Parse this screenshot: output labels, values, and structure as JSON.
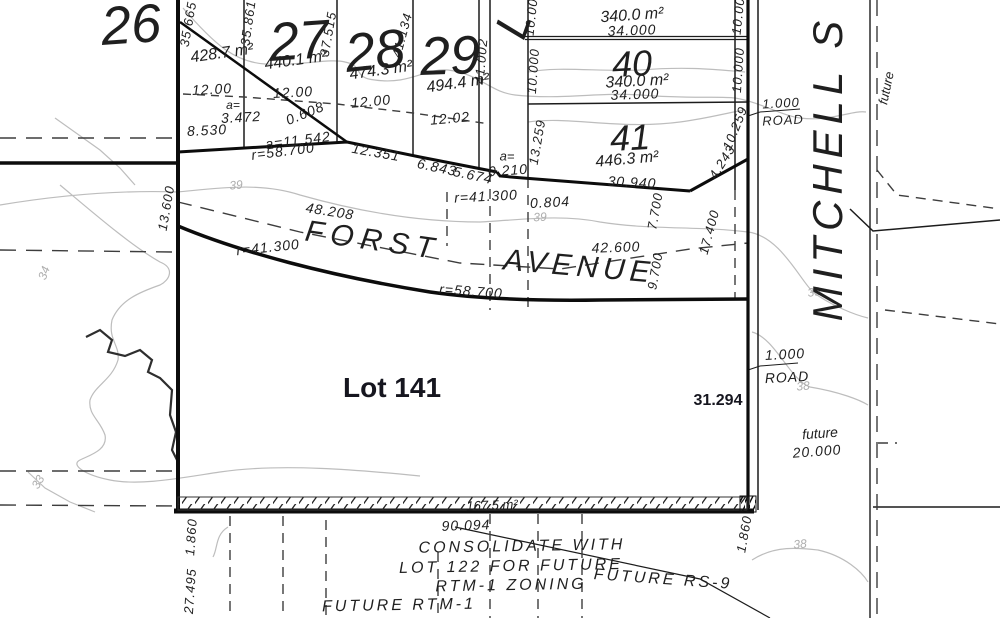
{
  "map": {
    "type": "cadastral-survey-plat",
    "colors": {
      "background": "#ffffff",
      "heavy_line": "#0c0c0c",
      "thin_line": "#1c1c1c",
      "dashed_line": "#3d3d3d",
      "contour_line": "#bdbdbd",
      "survey_text": "#1f1f1f",
      "annotation_text": "#16161f",
      "contour_text": "#aeaeae"
    },
    "streets": [
      "FORST AVENUE",
      "MITCHELL S"
    ],
    "labels": [
      {
        "id": "lot26-number",
        "t": "26",
        "x": 131,
        "y": 25,
        "r": -4,
        "s": 54
      },
      {
        "id": "lot26-area",
        "t": "428.7 m²",
        "x": 222,
        "y": 54,
        "r": -8,
        "s": 16
      },
      {
        "id": "lot27-number",
        "t": "27",
        "x": 299,
        "y": 41,
        "r": -4,
        "s": 54
      },
      {
        "id": "lot27-area",
        "t": "440.1 m²",
        "x": 296,
        "y": 61,
        "r": -8,
        "s": 16
      },
      {
        "id": "lot28-number",
        "t": "28",
        "x": 375,
        "y": 51,
        "r": -6,
        "s": 54
      },
      {
        "id": "lot28-area",
        "t": "474.3 m²",
        "x": 381,
        "y": 71,
        "r": -8,
        "s": 16
      },
      {
        "id": "lot29-number",
        "t": "29",
        "x": 450,
        "y": 56,
        "r": -2,
        "s": 54
      },
      {
        "id": "lot29-area",
        "t": "494.4 m²",
        "x": 458,
        "y": 84,
        "r": -8,
        "s": 16
      },
      {
        "id": "dim-35-665",
        "t": "35.665",
        "x": 188,
        "y": 24,
        "r": -80,
        "s": 13,
        "sp": 1
      },
      {
        "id": "dim-35-861",
        "t": "35.861",
        "x": 248,
        "y": 23,
        "r": -82,
        "s": 13,
        "sp": 1
      },
      {
        "id": "dim-37-515",
        "t": "37.515",
        "x": 328,
        "y": 34,
        "r": -80,
        "s": 13,
        "sp": 1
      },
      {
        "id": "dim-41-134",
        "t": "41.134",
        "x": 402,
        "y": 35,
        "r": -75,
        "s": 13,
        "sp": 1
      },
      {
        "id": "dim-41-002",
        "t": "41.002",
        "x": 481,
        "y": 61,
        "r": -85,
        "s": 13,
        "sp": 1
      },
      {
        "id": "zoning-fragment",
        "t": "RS 9",
        "x": 345,
        "y": -17,
        "r": 0,
        "s": 46,
        "sp": 14
      },
      {
        "id": "street-l-fragment",
        "t": "L",
        "x": 513,
        "y": 24,
        "r": -70,
        "s": 46
      },
      {
        "id": "lot39-area",
        "t": "340.0 m²",
        "x": 632,
        "y": 16,
        "r": -4,
        "s": 16
      },
      {
        "id": "lot39-frontage",
        "t": "34.000",
        "x": 632,
        "y": 30,
        "r": -2,
        "s": 14,
        "sp": 1
      },
      {
        "id": "lot40-number",
        "t": "40",
        "x": 632,
        "y": 64,
        "r": -3,
        "s": 36
      },
      {
        "id": "lot40-area",
        "t": "340.0 m²",
        "x": 637,
        "y": 82,
        "r": -3,
        "s": 16
      },
      {
        "id": "lot40-frontage",
        "t": "34.000",
        "x": 635,
        "y": 94,
        "r": -2,
        "s": 14,
        "sp": 1
      },
      {
        "id": "lot41-number",
        "t": "41",
        "x": 630,
        "y": 138,
        "r": -3,
        "s": 36
      },
      {
        "id": "lot41-area",
        "t": "446.3 m²",
        "x": 627,
        "y": 160,
        "r": -5,
        "s": 16
      },
      {
        "id": "dim-10-00-left39",
        "t": "10.00",
        "x": 531,
        "y": 17,
        "r": -84,
        "s": 13,
        "sp": 1
      },
      {
        "id": "dim-10-000-left40",
        "t": "10.000",
        "x": 533,
        "y": 71,
        "r": -86,
        "s": 13,
        "sp": 1
      },
      {
        "id": "dim-10-00-right39",
        "t": "10.00",
        "x": 738,
        "y": 16,
        "r": -84,
        "s": 13,
        "sp": 1
      },
      {
        "id": "dim-10-000-right40",
        "t": "10.000",
        "x": 738,
        "y": 70,
        "r": -86,
        "s": 13,
        "sp": 1
      },
      {
        "id": "dim-13-259",
        "t": "13.259",
        "x": 537,
        "y": 142,
        "r": -80,
        "s": 13,
        "sp": 1
      },
      {
        "id": "dim-10-259",
        "t": "10.259",
        "x": 735,
        "y": 128,
        "r": -68,
        "s": 13,
        "sp": 1
      },
      {
        "id": "dim-4-243",
        "t": "4.243",
        "x": 722,
        "y": 162,
        "r": -58,
        "s": 13,
        "sp": 1
      },
      {
        "id": "dim-30-940",
        "t": "30.940",
        "x": 632,
        "y": 182,
        "r": 3,
        "s": 14,
        "sp": 1
      },
      {
        "id": "dim-a-equals-e",
        "t": "a=",
        "x": 507,
        "y": 156,
        "r": 0,
        "s": 13
      },
      {
        "id": "dim-0-210",
        "t": "0.210",
        "x": 508,
        "y": 170,
        "r": -4,
        "s": 14,
        "sp": 1
      },
      {
        "id": "dim-12-00-a",
        "t": "12.00",
        "x": 212,
        "y": 89,
        "r": -3,
        "s": 14,
        "sp": 1
      },
      {
        "id": "dim-12-00-b",
        "t": "12.00",
        "x": 293,
        "y": 92,
        "r": -3,
        "s": 14,
        "sp": 1
      },
      {
        "id": "dim-12-00-c",
        "t": "12.00",
        "x": 371,
        "y": 101,
        "r": -5,
        "s": 14,
        "sp": 1
      },
      {
        "id": "dim-12-02",
        "t": "12.02",
        "x": 450,
        "y": 118,
        "r": -5,
        "s": 14,
        "sp": 1
      },
      {
        "id": "dim-a-equals-w",
        "t": "a=",
        "x": 233,
        "y": 105,
        "r": 0,
        "s": 12
      },
      {
        "id": "dim-3-472",
        "t": "3.472",
        "x": 241,
        "y": 117,
        "r": -3,
        "s": 14,
        "sp": 1
      },
      {
        "id": "dim-8-530",
        "t": "8.530",
        "x": 207,
        "y": 130,
        "r": -3,
        "s": 14,
        "sp": 1
      },
      {
        "id": "dim-0-608",
        "t": "0.608",
        "x": 305,
        "y": 113,
        "r": -22,
        "s": 14,
        "sp": 1
      },
      {
        "id": "dim-a-11-542",
        "t": "a=11.542",
        "x": 298,
        "y": 140,
        "r": -7,
        "s": 14,
        "sp": 1
      },
      {
        "id": "dim-r-58-700-n",
        "t": "r=58.700",
        "x": 283,
        "y": 151,
        "r": -7,
        "s": 14,
        "sp": 1
      },
      {
        "id": "dim-12-351",
        "t": "12.351",
        "x": 376,
        "y": 152,
        "r": 10,
        "s": 14,
        "sp": 1
      },
      {
        "id": "dim-6-843",
        "t": "6.843",
        "x": 437,
        "y": 167,
        "r": 12,
        "s": 14,
        "sp": 1
      },
      {
        "id": "dim-5-674",
        "t": "5.674",
        "x": 473,
        "y": 175,
        "r": 12,
        "s": 14,
        "sp": 1
      },
      {
        "id": "dim-13-600",
        "t": "13.600",
        "x": 166,
        "y": 208,
        "r": -80,
        "s": 13,
        "sp": 1
      },
      {
        "id": "dim-48-208",
        "t": "48.208",
        "x": 330,
        "y": 211,
        "r": 9,
        "s": 14,
        "sp": 1
      },
      {
        "id": "street-forst",
        "t": "FORST",
        "x": 373,
        "y": 241,
        "r": 8,
        "s": 30,
        "sp": 7
      },
      {
        "id": "street-avenue",
        "t": "AVENUE",
        "x": 579,
        "y": 267,
        "r": 5,
        "s": 30,
        "sp": 5
      },
      {
        "id": "dim-r-41-300-w",
        "t": "r=41.300",
        "x": 268,
        "y": 247,
        "r": -6,
        "s": 14,
        "sp": 1
      },
      {
        "id": "dim-r-41-300-e",
        "t": "r=41.300",
        "x": 486,
        "y": 196,
        "r": -3,
        "s": 14,
        "sp": 1
      },
      {
        "id": "dim-0-804",
        "t": "0.804",
        "x": 550,
        "y": 202,
        "r": -3,
        "s": 14,
        "sp": 1
      },
      {
        "id": "dim-42-600",
        "t": "42.600",
        "x": 616,
        "y": 247,
        "r": -2,
        "s": 14,
        "sp": 1
      },
      {
        "id": "dim-r-58-700-s",
        "t": "r=58.700",
        "x": 471,
        "y": 291,
        "r": 4,
        "s": 14,
        "sp": 1
      },
      {
        "id": "dim-7-700",
        "t": "7.700",
        "x": 655,
        "y": 211,
        "r": -80,
        "s": 13,
        "sp": 1
      },
      {
        "id": "dim-9-700",
        "t": "9.700",
        "x": 655,
        "y": 271,
        "r": -80,
        "s": 13,
        "sp": 1
      },
      {
        "id": "dim-17-400",
        "t": "17.400",
        "x": 709,
        "y": 232,
        "r": -75,
        "s": 13,
        "sp": 1
      },
      {
        "id": "contour-39-a",
        "t": "39",
        "x": 236,
        "y": 185,
        "r": -5,
        "s": 12,
        "f": "contour-lbl"
      },
      {
        "id": "contour-39-b",
        "t": "39",
        "x": 540,
        "y": 217,
        "r": -3,
        "s": 12,
        "f": "contour-lbl"
      },
      {
        "id": "contour-39-c",
        "t": "39",
        "x": 814,
        "y": 292,
        "r": -8,
        "s": 12,
        "f": "contour-lbl"
      },
      {
        "id": "contour-38-a",
        "t": "38",
        "x": 803,
        "y": 386,
        "r": -5,
        "s": 12,
        "f": "contour-lbl"
      },
      {
        "id": "contour-38-b",
        "t": "38",
        "x": 800,
        "y": 544,
        "r": -5,
        "s": 12,
        "f": "contour-lbl"
      },
      {
        "id": "contour-34",
        "t": "34",
        "x": 44,
        "y": 273,
        "r": -70,
        "s": 12,
        "f": "contour-lbl"
      },
      {
        "id": "contour-33",
        "t": "33",
        "x": 38,
        "y": 482,
        "r": -60,
        "s": 12,
        "f": "contour-lbl"
      },
      {
        "id": "lot141-label",
        "t": "Lot 141",
        "x": 392,
        "y": 388,
        "r": 0,
        "s": 28,
        "f": "annot"
      },
      {
        "id": "dim-31-294",
        "t": "31.294",
        "x": 718,
        "y": 401,
        "r": 0,
        "s": 16,
        "f": "annot"
      },
      {
        "id": "road-1-000-n",
        "t": "1.000",
        "x": 781,
        "y": 103,
        "r": -3,
        "s": 13,
        "sp": 1
      },
      {
        "id": "road-label-n",
        "t": "ROAD",
        "x": 783,
        "y": 120,
        "r": -3,
        "s": 13,
        "sp": 1
      },
      {
        "id": "road-1-000-s",
        "t": "1.000",
        "x": 785,
        "y": 354,
        "r": -3,
        "s": 14,
        "sp": 1
      },
      {
        "id": "road-label-s",
        "t": "ROAD",
        "x": 787,
        "y": 377,
        "r": -3,
        "s": 14,
        "sp": 1
      },
      {
        "id": "future-label-n",
        "t": "future",
        "x": 886,
        "y": 88,
        "r": -78,
        "s": 13
      },
      {
        "id": "future-label-s",
        "t": "future",
        "x": 820,
        "y": 433,
        "r": -4,
        "s": 14
      },
      {
        "id": "dim-20-000",
        "t": "20.000",
        "x": 817,
        "y": 451,
        "r": -4,
        "s": 14,
        "sp": 1
      },
      {
        "id": "street-mitchell",
        "t": "MITCHELL S",
        "x": 828,
        "y": 168,
        "r": -90,
        "s": 42,
        "sp": 6
      },
      {
        "id": "strip-area",
        "t": "167.5 m²",
        "x": 492,
        "y": 505,
        "r": -2,
        "s": 13
      },
      {
        "id": "dim-90-094",
        "t": "90.094",
        "x": 466,
        "y": 525,
        "r": -2,
        "s": 14,
        "sp": 1
      },
      {
        "id": "note-consolidate-1",
        "t": "CONSOLIDATE WITH",
        "x": 522,
        "y": 547,
        "r": -1,
        "s": 16,
        "sp": 3
      },
      {
        "id": "note-consolidate-2",
        "t": "LOT 122 FOR FUTURE",
        "x": 511,
        "y": 567,
        "r": -1,
        "s": 16,
        "sp": 3
      },
      {
        "id": "note-consolidate-3",
        "t": "RTM-1 ZONING",
        "x": 511,
        "y": 586,
        "r": -1,
        "s": 16,
        "sp": 3
      },
      {
        "id": "note-future-rtm1",
        "t": "FUTURE RTM-1",
        "x": 399,
        "y": 606,
        "r": -1,
        "s": 16,
        "sp": 3
      },
      {
        "id": "note-future-rs9",
        "t": "FUTURE RS-9",
        "x": 663,
        "y": 580,
        "r": 4,
        "s": 16,
        "sp": 3
      },
      {
        "id": "dim-27-495",
        "t": "27.495",
        "x": 190,
        "y": 591,
        "r": -86,
        "s": 13,
        "sp": 1
      },
      {
        "id": "dim-1-860-w",
        "t": "1.860",
        "x": 191,
        "y": 537,
        "r": -86,
        "s": 13,
        "sp": 1
      },
      {
        "id": "dim-1-860-e",
        "t": "1.860",
        "x": 744,
        "y": 534,
        "r": -80,
        "s": 13,
        "sp": 1
      }
    ]
  }
}
